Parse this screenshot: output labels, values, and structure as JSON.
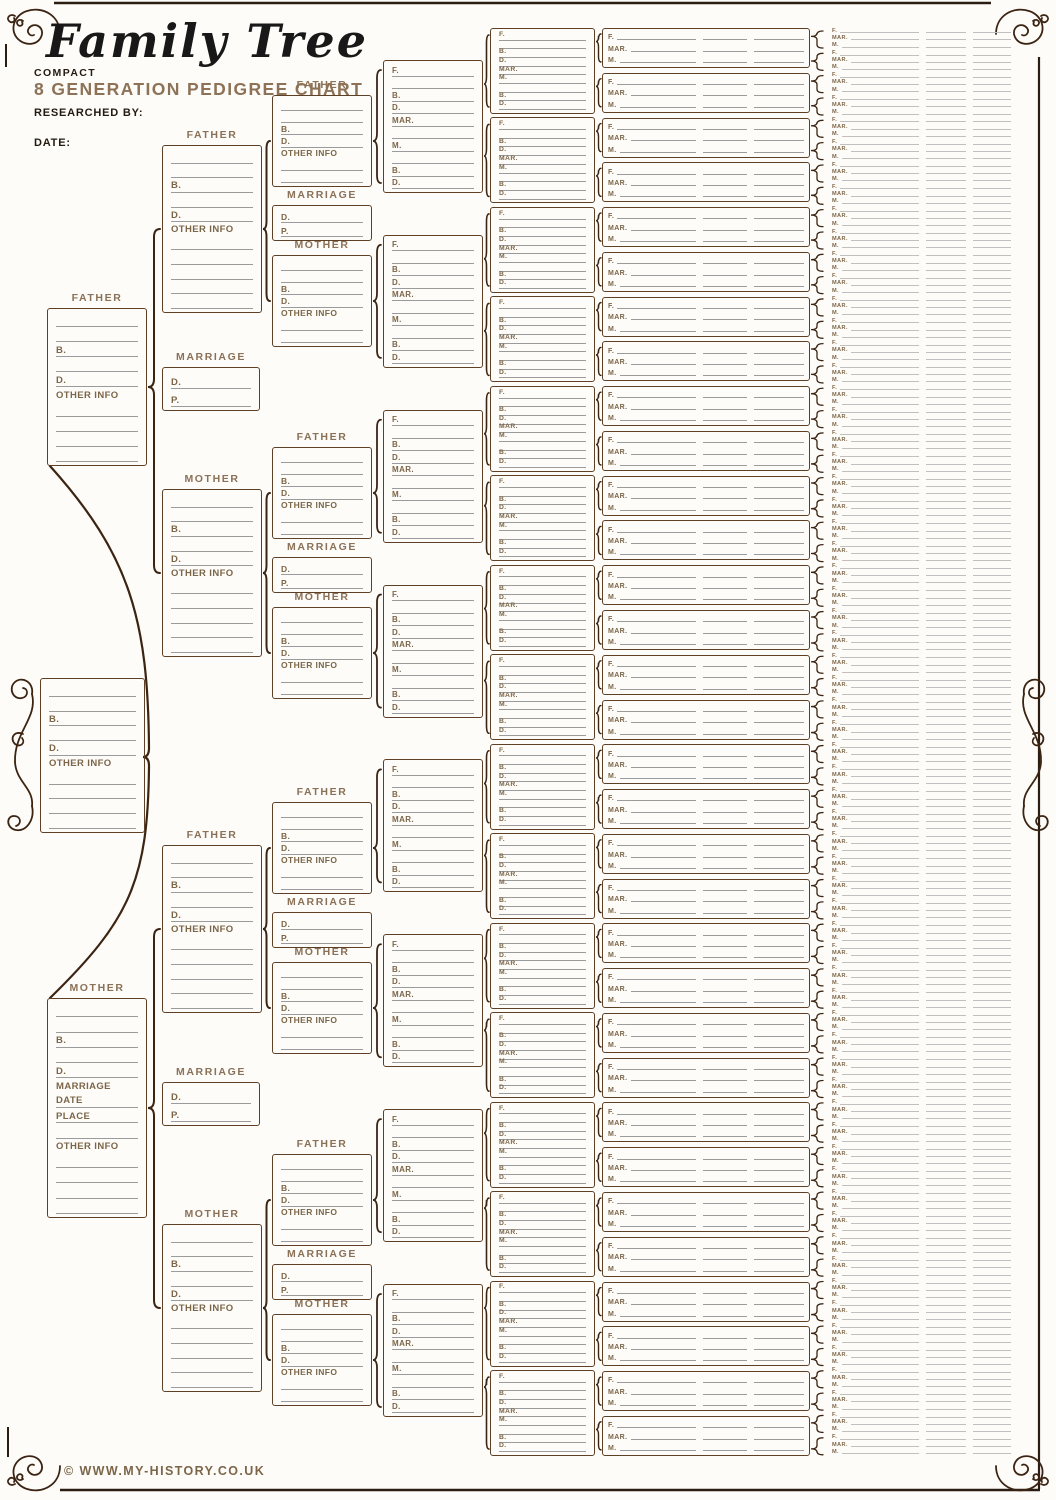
{
  "header": {
    "title": "Family Tree",
    "edition": "COMPACT",
    "subtitle": "8 GENERATION PEDIGREE CHART",
    "researched_by": "RESEARCHED BY:",
    "date": "DATE:"
  },
  "footer": {
    "copyright": "© WWW.MY-HISTORY.CO.UK"
  },
  "labels": {
    "father": "FATHER",
    "mother": "MOTHER",
    "marriage": "MARRIAGE"
  },
  "boxes": {
    "gen1_root": {
      "rows": [
        "_",
        "_",
        "B.",
        "_",
        "D.",
        "OTHER INFO*",
        "_",
        "_",
        "_",
        "_"
      ]
    },
    "gen2_father": {
      "title": "FATHER",
      "rows": [
        "_",
        "_",
        "B.",
        "_",
        "D.",
        "OTHER INFO*",
        "_",
        "_",
        "_",
        "_"
      ]
    },
    "gen2_mother": {
      "title": "MOTHER",
      "rows": [
        "_",
        "_",
        "B.",
        "_",
        "D.",
        "MARRIAGE*",
        "DATE",
        "PLACE",
        "_",
        "OTHER INFO*",
        "_",
        "_",
        "_",
        "_"
      ]
    },
    "gen3_person": {
      "rows": [
        "_",
        "_",
        "B.",
        "_",
        "D.",
        "OTHER INFO*",
        "_",
        "_",
        "_",
        "_",
        "_"
      ]
    },
    "gen4_person": {
      "rows": [
        "_",
        "_",
        "B.",
        "D.",
        "OTHER INFO*",
        "_",
        "_"
      ]
    },
    "marriage": {
      "title": "MARRIAGE",
      "rows": [
        "D.",
        "P."
      ]
    },
    "gen5_couple": {
      "count": 8,
      "rows": [
        "F.",
        "_",
        "B.",
        "D.",
        "MAR.",
        "_",
        "M.",
        "_",
        "B.",
        "D."
      ]
    },
    "gen6_couple": {
      "count": 16,
      "rows": [
        "F.",
        "_",
        "B.",
        "D.",
        "MAR.",
        "M.",
        "_",
        "B.",
        "D."
      ]
    },
    "gen7_couple": {
      "count": 32,
      "rows": [
        "F.",
        "MAR.",
        "M."
      ]
    },
    "gen8_couple": {
      "count": 64,
      "rows": [
        "F.",
        "MAR.",
        "M."
      ]
    }
  },
  "colors": {
    "bg": "#fdfcf9",
    "border": "#5e4027",
    "label": "#7c6649",
    "title_label": "#8a7158",
    "subtitle": "#8d7257",
    "dark": "#241a10",
    "line": "#9b9b9b",
    "light_line": "#c0c0c0",
    "connector": "#3c2413",
    "edge": "#2b1d12",
    "script": "#181818"
  }
}
